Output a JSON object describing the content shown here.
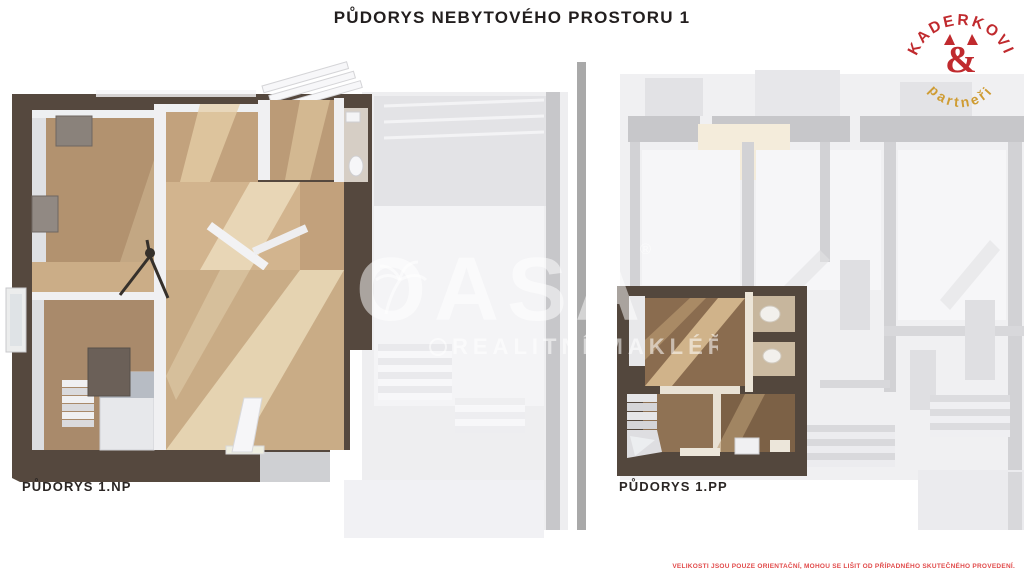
{
  "header": {
    "title": "PŮDORYS NEBYTOVÉHO PROSTORU 1"
  },
  "logo": {
    "arc_top": "KADERKOVI",
    "ampersand": "&",
    "arc_bottom": "partneři",
    "color_red": "#c02a2e",
    "color_gold": "#cf9c33"
  },
  "plans": {
    "left_label": "PŮDORYS 1.NP",
    "right_label": "PŮDORYS 1.PP"
  },
  "watermark": {
    "brand": "OASA",
    "registered": "®",
    "tagline": "REALITNÍ MAKLÉŘ"
  },
  "footer": {
    "disclaimer": "VELIKOSTI JSOU POUZE ORIENTAČNÍ, MOHOU SE LIŠIT OD PŘÍPADNÉHO SKUTEČNÉHO PROVEDENÍ."
  },
  "colors": {
    "wall_dark": "#55483e",
    "floor_wood": "#b2926f",
    "floor_sunlit": "#ead9b8",
    "faded_grey": "#f0f0f2",
    "divider": "#a9a9a9",
    "disclaimer_red": "#e14b4b"
  }
}
